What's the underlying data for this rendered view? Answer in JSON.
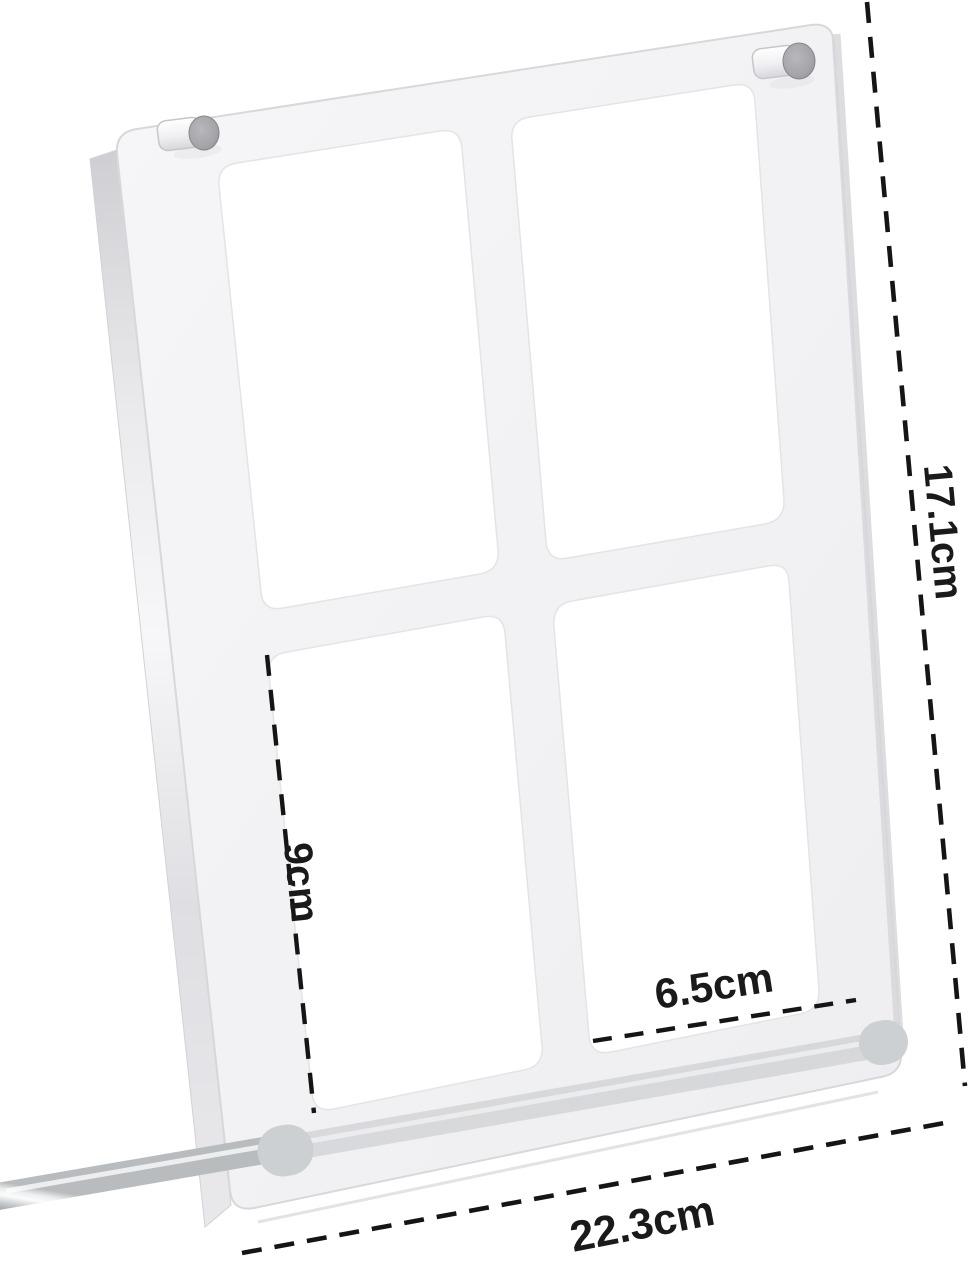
{
  "measurements": {
    "frame_height": {
      "label": "17.1cm"
    },
    "pocket_height": {
      "label": "9cm"
    },
    "pocket_width": {
      "label": "6.5cm"
    },
    "frame_width": {
      "label": "22.3cm"
    }
  },
  "colors": {
    "dash_line": "#151515",
    "label_text": "#1a1a1a",
    "acrylic_plate": "#f3f3f5",
    "pocket_window": "#ffffff",
    "metal_highlight": "#fbfcfd",
    "metal_shadow": "#a2a5a8",
    "background": "#ffffff"
  }
}
